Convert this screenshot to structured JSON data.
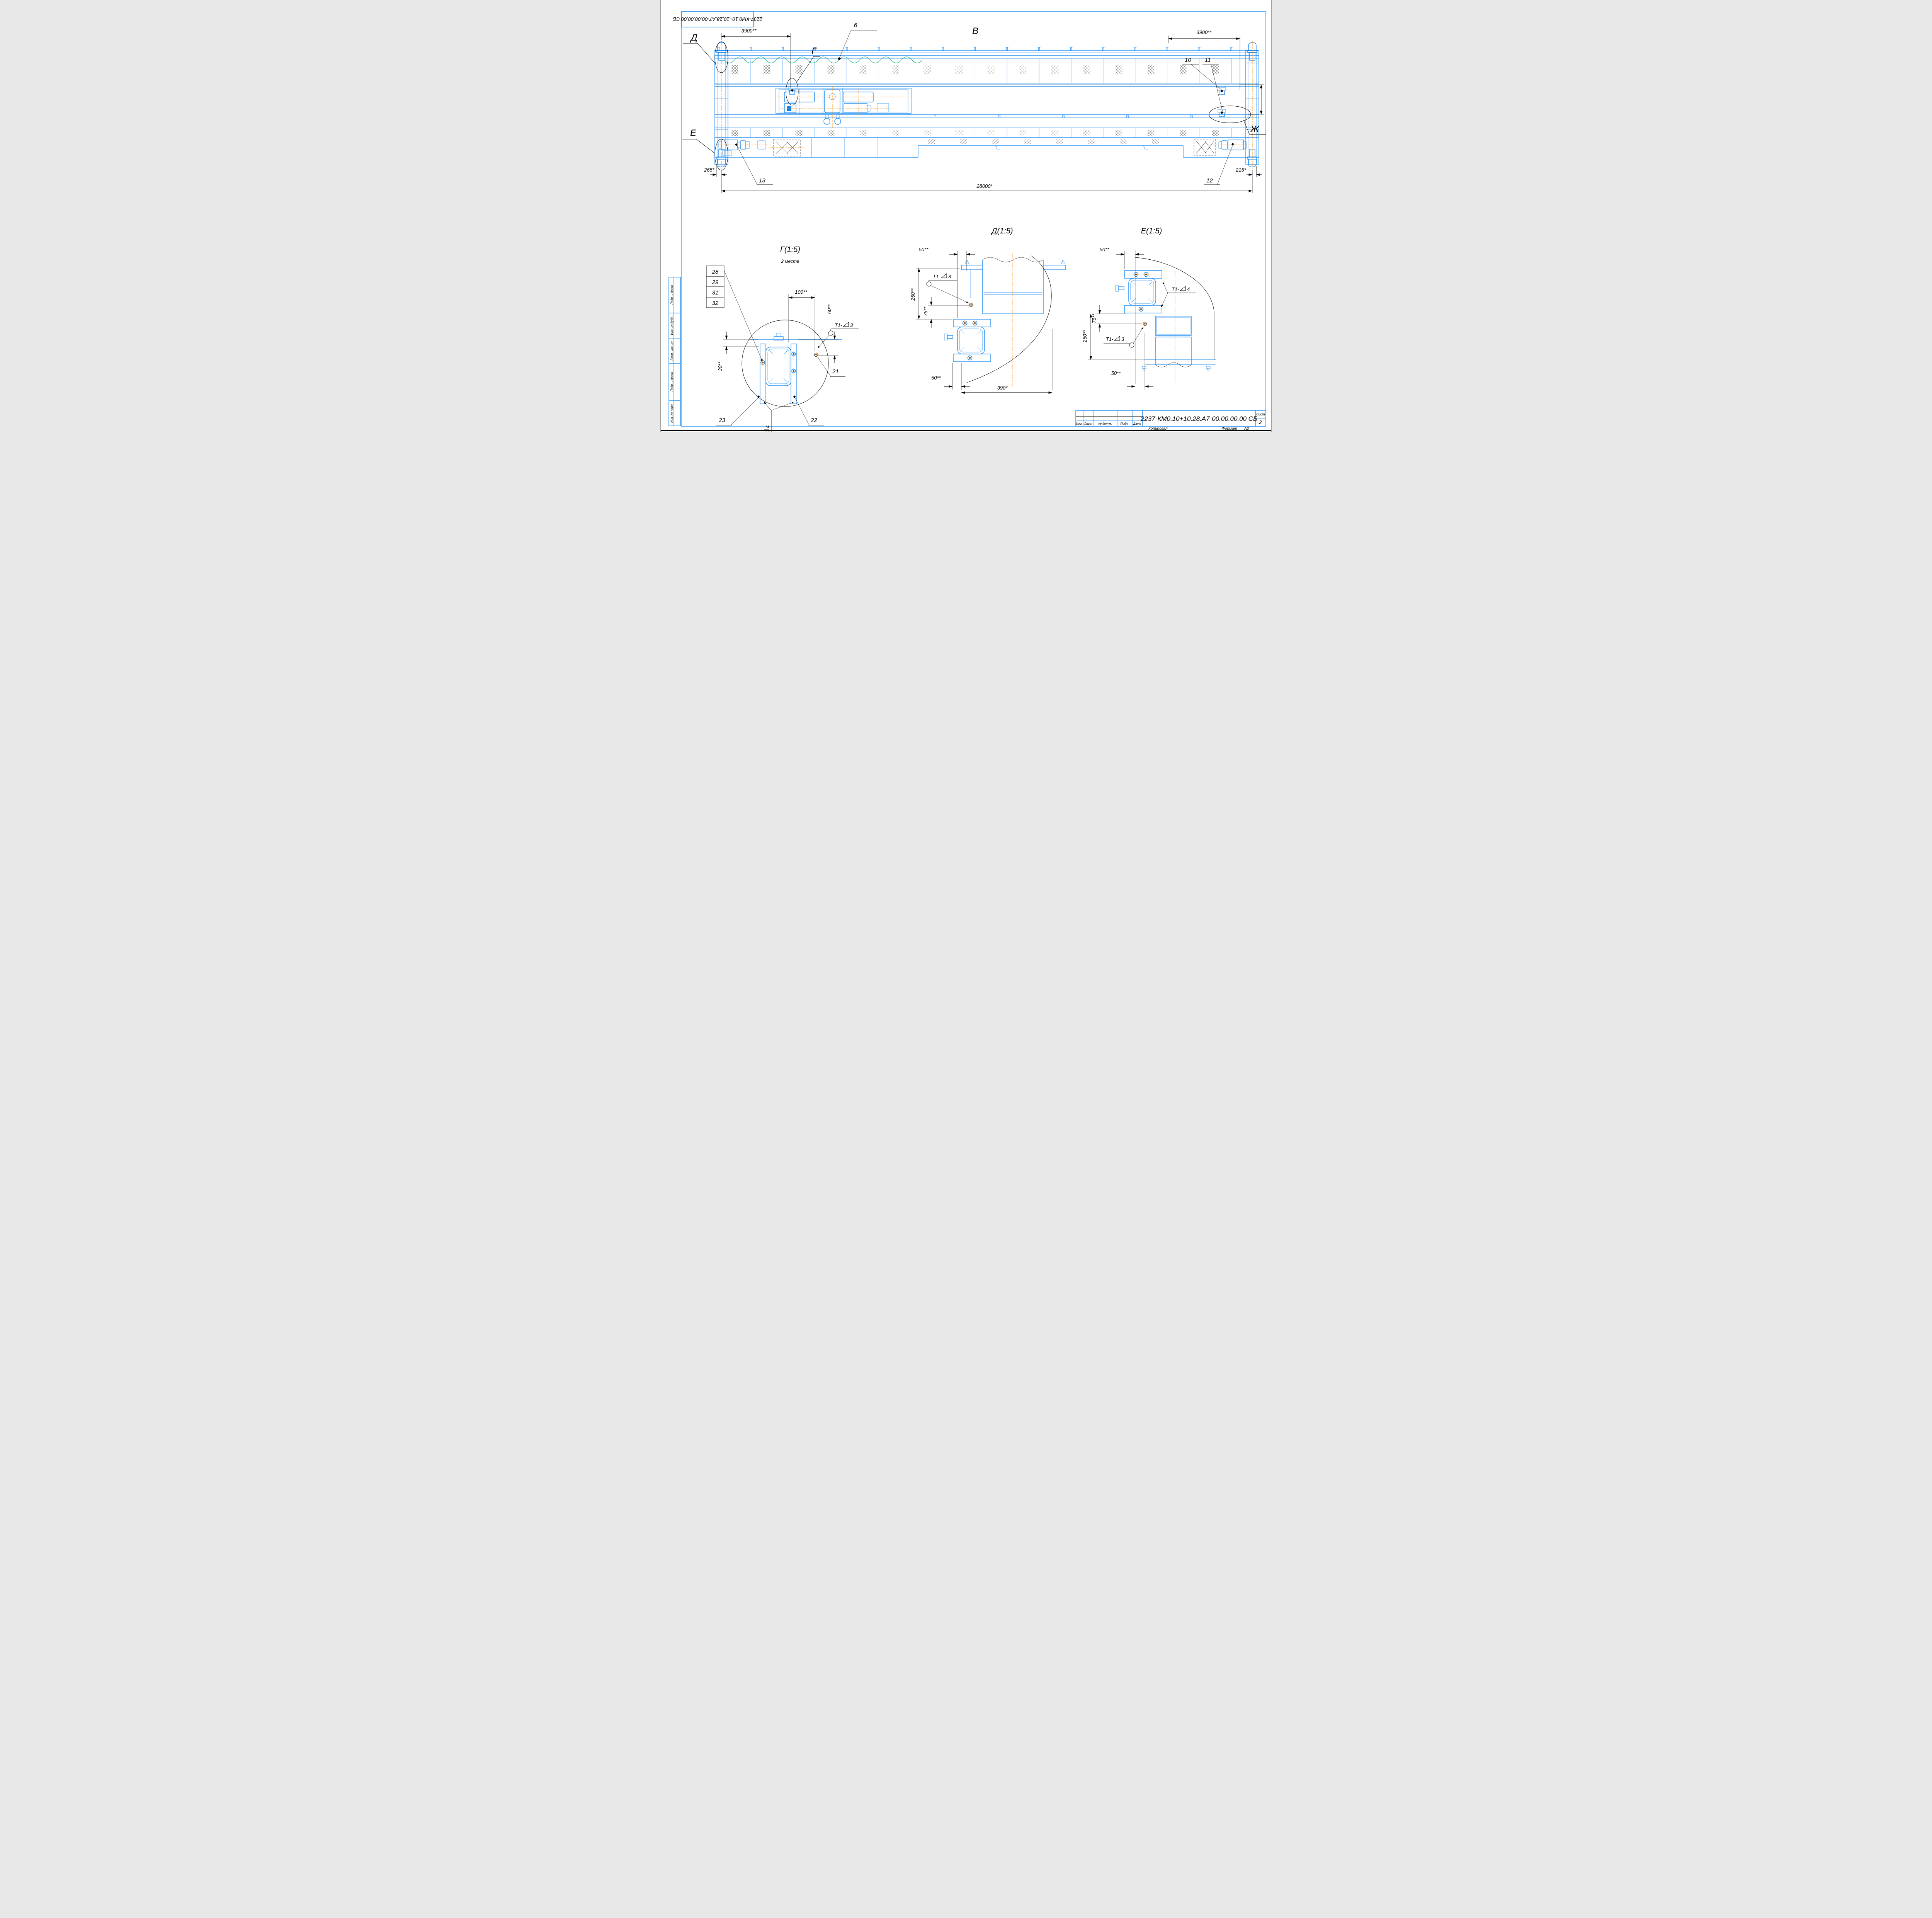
{
  "sheet": {
    "stamp_top_left": "2237-КМ0,10+10,28.А7-00.00.00,00 СБ",
    "doc_number": "2237-КМ0.10+10.28.А7-00.00.00.00 СБ",
    "sheet_label": "Лист",
    "sheet_number": "2",
    "copied_label": "Копировал",
    "format_label": "Формат",
    "format_value": "А2",
    "tb_cols": [
      "Изм.",
      "Лист",
      "№ докум.",
      "Подп.",
      "Дата"
    ],
    "side_labels": [
      "Подп. и дата",
      "Инв. № дубл.",
      "Взам. инв. №",
      "Подп. и дата",
      "Инв. № подл."
    ]
  },
  "main_view": {
    "view_label": "В",
    "section_d": "Д",
    "section_g": "Г",
    "section_e": "Е",
    "section_zh": "Ж",
    "dim_3900_left": "3900**",
    "dim_3900_right": "3900**",
    "dim_span": "28000*",
    "dim_gauge": "1800",
    "dim_265": "265*",
    "dim_215": "215*",
    "callout_6": "6",
    "callout_10": "10",
    "callout_11": "11",
    "callout_12": "12",
    "callout_13": "13"
  },
  "welds": {
    "prefix": "Т1-",
    "n3": "3",
    "n4": "4"
  },
  "detail_g": {
    "title": "Г(1:5)",
    "note": "2 места",
    "stack": [
      "28",
      "29",
      "31",
      "32"
    ],
    "c21": "21",
    "c22": "22",
    "c23": "23",
    "d100": "100**",
    "d60": "60**",
    "d30": "30**"
  },
  "detail_d": {
    "title": "Д(1:5)",
    "d50_top": "50**",
    "d250": "250**",
    "d75": "75**",
    "d50_bot": "50**",
    "d390": "390*"
  },
  "detail_e": {
    "title": "Е(1:5)",
    "d50_top": "50**",
    "d75": "75**",
    "d250": "250**",
    "d50_bot": "50**"
  },
  "colors": {
    "line_blue": "#0b82f0",
    "centerline_orange": "#ff8a00",
    "festoon_teal": "#00a887",
    "annotation_black": "#000000",
    "paper_white": "#ffffff"
  }
}
